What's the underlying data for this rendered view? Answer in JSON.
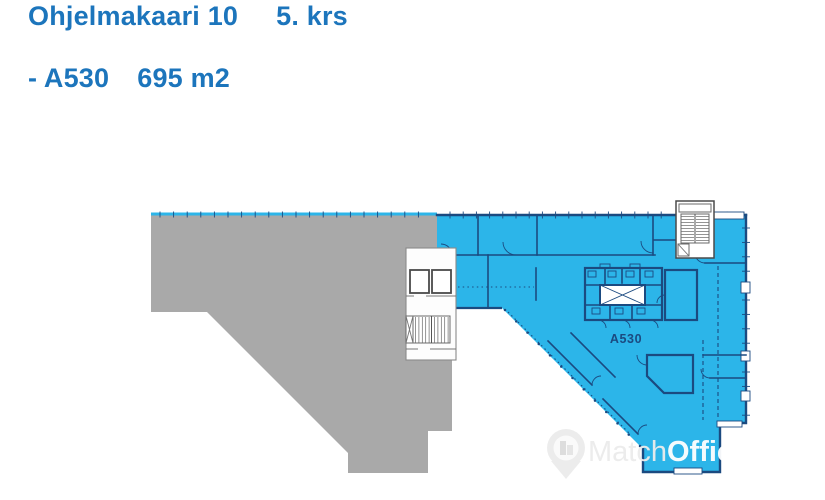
{
  "header": {
    "title": "Ohjelmakaari 10",
    "floor": "5. krs"
  },
  "unit_line": {
    "unit": "- A530",
    "area": "695 m2"
  },
  "floorplan": {
    "unit_label": "A530"
  },
  "watermark": {
    "match": "Match",
    "office": "Office"
  },
  "colors": {
    "heading_blue": "#1c75bc",
    "area_blue": "#2cb5e9",
    "area_gray": "#a9a9a9",
    "wall_navy": "#1b4a80"
  }
}
